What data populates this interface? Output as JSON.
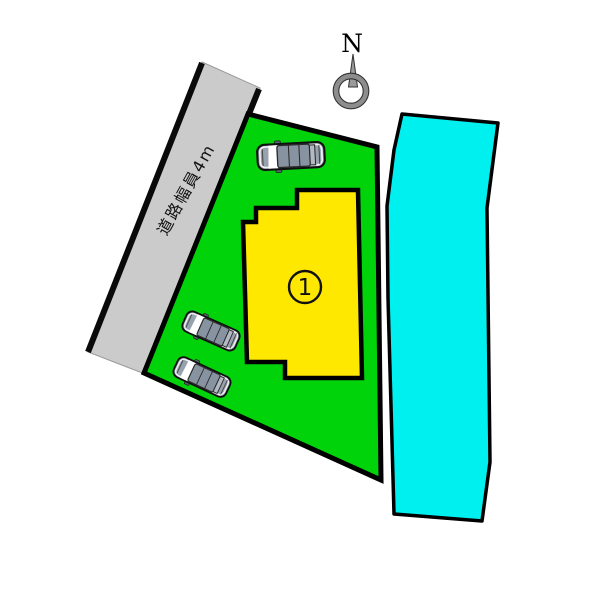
{
  "compass": {
    "label": "N"
  },
  "road": {
    "label": "道路幅員4m"
  },
  "lot": {
    "number": "1"
  },
  "cars": {
    "count": "3"
  },
  "colors": {
    "lot_green": "#00D30A",
    "building_yellow": "#FFE800",
    "road_gray": "#CBCBCB",
    "strip_cyan": "#00F0F0",
    "outline_black": "#000000",
    "car_body": "#98A2AF",
    "car_cabin": "#8793A1",
    "car_rear_window": "#B3BAC4",
    "compass_gray": "#8D8D8D"
  }
}
